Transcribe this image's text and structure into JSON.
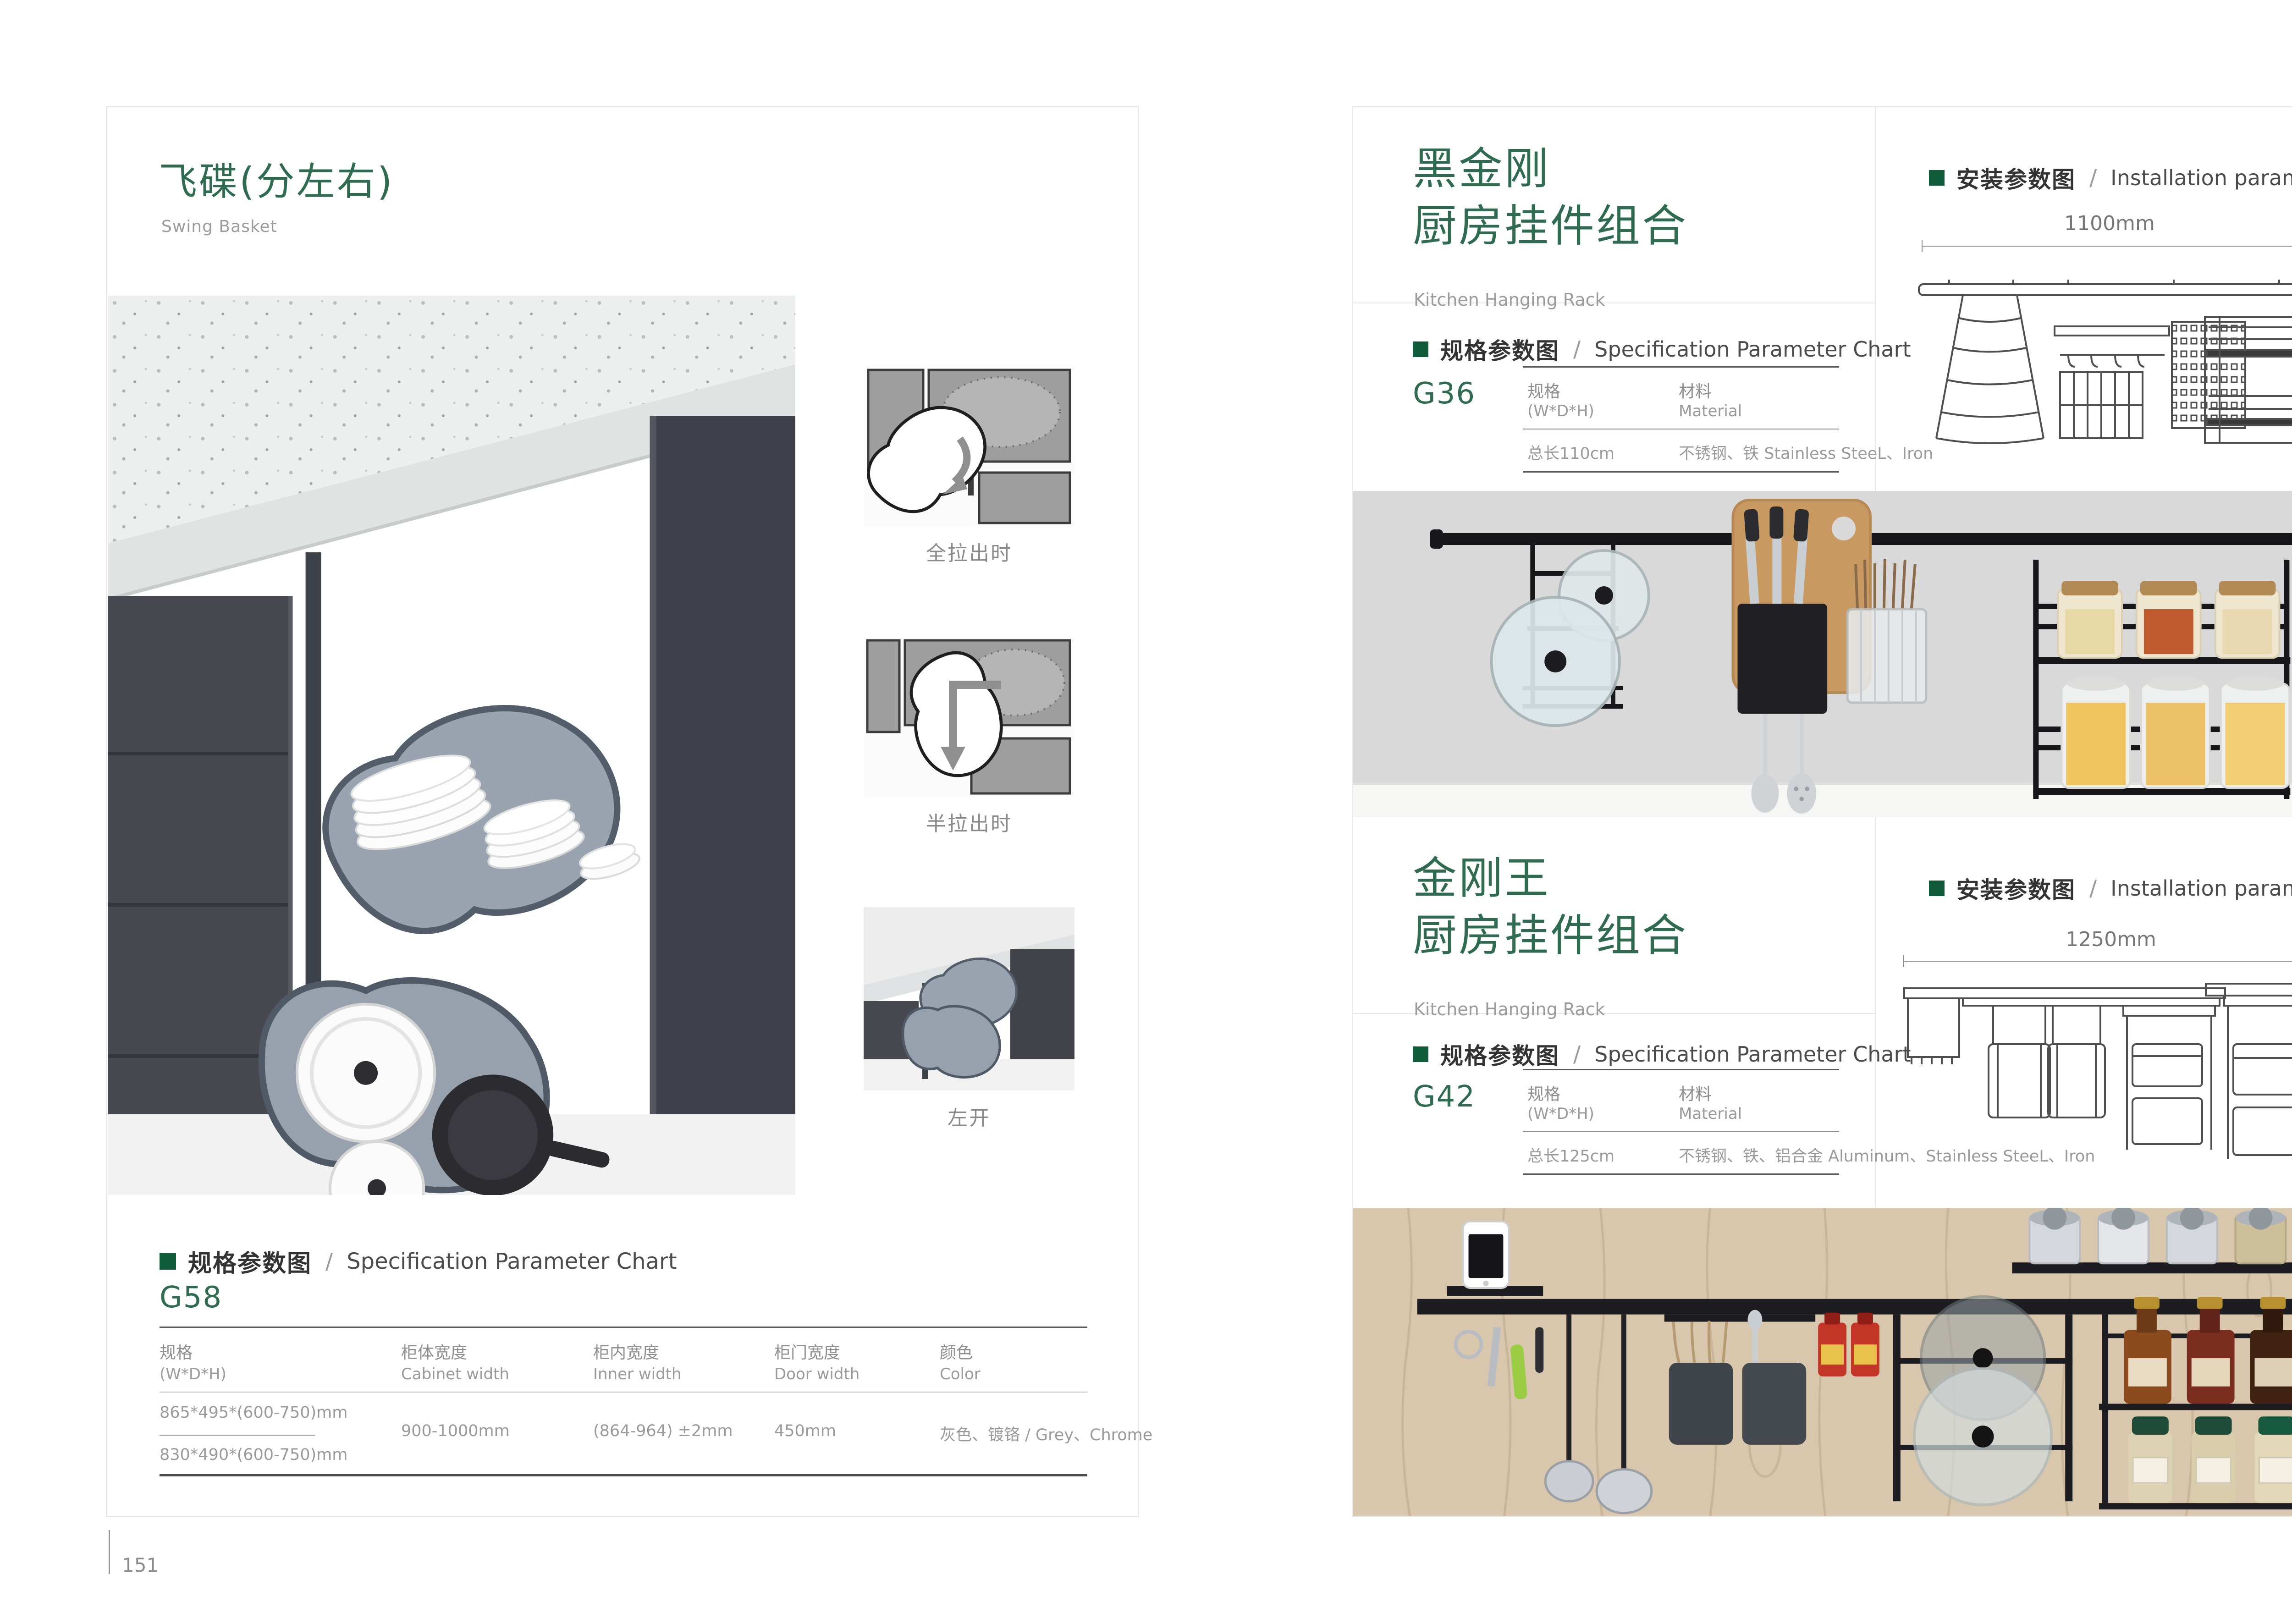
{
  "accent": {
    "title_green": "#2f6b50",
    "marker_green": "#0f5b3a"
  },
  "left_page": {
    "title_cn": "飞碟(分左右)",
    "title_en": "Swing Basket",
    "figures": [
      {
        "caption": "全拉出时"
      },
      {
        "caption": "半拉出时"
      },
      {
        "caption": "左开"
      }
    ],
    "spec": {
      "header_cn": "规格参数图",
      "sep": "/",
      "header_en": "Specification Parameter Chart",
      "model": "G58",
      "columns": [
        {
          "cn": "规格",
          "en": "(W*D*H)"
        },
        {
          "cn": "柜体宽度",
          "en": "Cabinet width"
        },
        {
          "cn": "柜内宽度",
          "en": "Inner width"
        },
        {
          "cn": "柜门宽度",
          "en": "Door width"
        },
        {
          "cn": "颜色",
          "en": "Color"
        }
      ],
      "spec_value_1": "865*495*(600-750)mm",
      "spec_value_2": "830*490*(600-750)mm",
      "cabinet_width": "900-1000mm",
      "inner_width": "(864-964) ±2mm",
      "door_width": "450mm",
      "color": "灰色、镀铬 / Grey、Chrome"
    },
    "page_number": "151"
  },
  "right_page": {
    "section_g36": {
      "title_cn_line1": "黑金刚",
      "title_cn_line2": "厨房挂件组合",
      "title_en": "Kitchen Hanging Rack",
      "install": {
        "header_cn": "安装参数图",
        "sep": "/",
        "header_en": "Installation parameters",
        "width_label": "1100mm",
        "height_label": "420mm"
      },
      "spec": {
        "header_cn": "规格参数图",
        "sep": "/",
        "header_en": "Specification Parameter Chart",
        "model": "G36",
        "col1_cn": "规格",
        "col1_en": "(W*D*H)",
        "col2_cn": "材料",
        "col2_en": "Material",
        "row_spec": "总长110cm",
        "row_material": "不锈钢、铁  Stainless SteeL、Iron"
      }
    },
    "section_g42": {
      "title_cn_line1": "金刚王",
      "title_cn_line2": "厨房挂件组合",
      "title_en": "Kitchen Hanging Rack",
      "install": {
        "header_cn": "安装参数图",
        "sep": "/",
        "header_en": "Installation parameters",
        "width_label": "1250mm",
        "height_label": "430mm"
      },
      "spec": {
        "header_cn": "规格参数图",
        "sep": "/",
        "header_en": "Specification Parameter Chart",
        "model": "G42",
        "col1_cn": "规格",
        "col1_en": "(W*D*H)",
        "col2_cn": "材料",
        "col2_en": "Material",
        "row_spec": "总长125cm",
        "row_material": "不锈钢、铁、铝合金  Aluminum、Stainless SteeL、Iron"
      }
    },
    "page_number": "152"
  }
}
